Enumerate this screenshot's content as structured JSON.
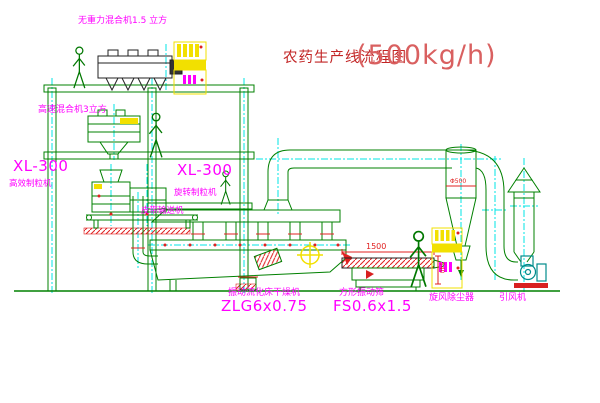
{
  "page": {
    "title_zh": "农药生产线流程图",
    "title_capacity": "(500kg/h)"
  },
  "equipment_labels": {
    "gravity_free_mixer": "无重力混合机1.5 立方",
    "high_speed_mixer": "高速混合机3立方",
    "granulator_left": {
      "model": "XL-300",
      "name": "高效制粒机"
    },
    "granulator_center": {
      "model": "XL-300",
      "name": "旋转制粒机"
    },
    "belt_conveyor": "皮带输送机",
    "fluid_bed_dryer": {
      "name": "振动流化床干燥机",
      "model": "ZLG6x0.75"
    },
    "square_vibrating_screen": {
      "name": "方形振动筛",
      "model": "FS0.6x1.5"
    },
    "cyclone_dust_collector": "旋风除尘器",
    "induced_draft_fan": "引风机"
  },
  "dimensions": {
    "screen_length": "1500",
    "screen_height": "540",
    "cyclone_diameter": "Φ500"
  },
  "colors": {
    "line_green": "#008000",
    "centerline_cyan": "#00e5e5",
    "label_magenta": "#ff00ff",
    "title_red": "#c22525",
    "cabinet_yellow": "#f2e000",
    "accent_red": "#e02020",
    "fan_teal": "#008b8b"
  }
}
